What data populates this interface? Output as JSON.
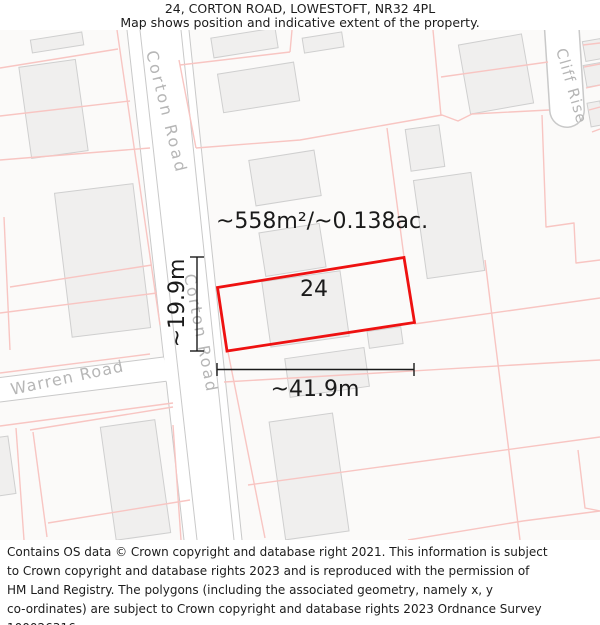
{
  "header": {
    "title": "24, CORTON ROAD, LOWESTOFT, NR32 4PL",
    "subtitle": "Map shows position and indicative extent of the property."
  },
  "map": {
    "plot_number": "24",
    "area_label": "~558m²/~0.138ac.",
    "width_label": "~41.9m",
    "height_label": "~19.9m",
    "road_labels": [
      "Corton Road",
      "Corton Road",
      "Warren Road",
      "Cliff Rise"
    ],
    "colors": {
      "property_outline": "#ee1111",
      "parcel_line": "#f8c5c2",
      "building_fill": "#f0efee",
      "building_stroke": "#cfcfcf",
      "road_edge": "#c9c9c9",
      "road_label": "#b6b6b6",
      "annotation": "#1a1a1a"
    }
  },
  "footer": {
    "lines": [
      "Contains OS data © Crown copyright and database right 2021. This information is subject",
      "to Crown copyright and database rights 2023 and is reproduced with the permission of",
      "HM Land Registry. The polygons (including the associated geometry, namely x, y",
      "co-ordinates) are subject to Crown copyright and database rights 2023 Ordnance Survey",
      "100026316."
    ]
  }
}
